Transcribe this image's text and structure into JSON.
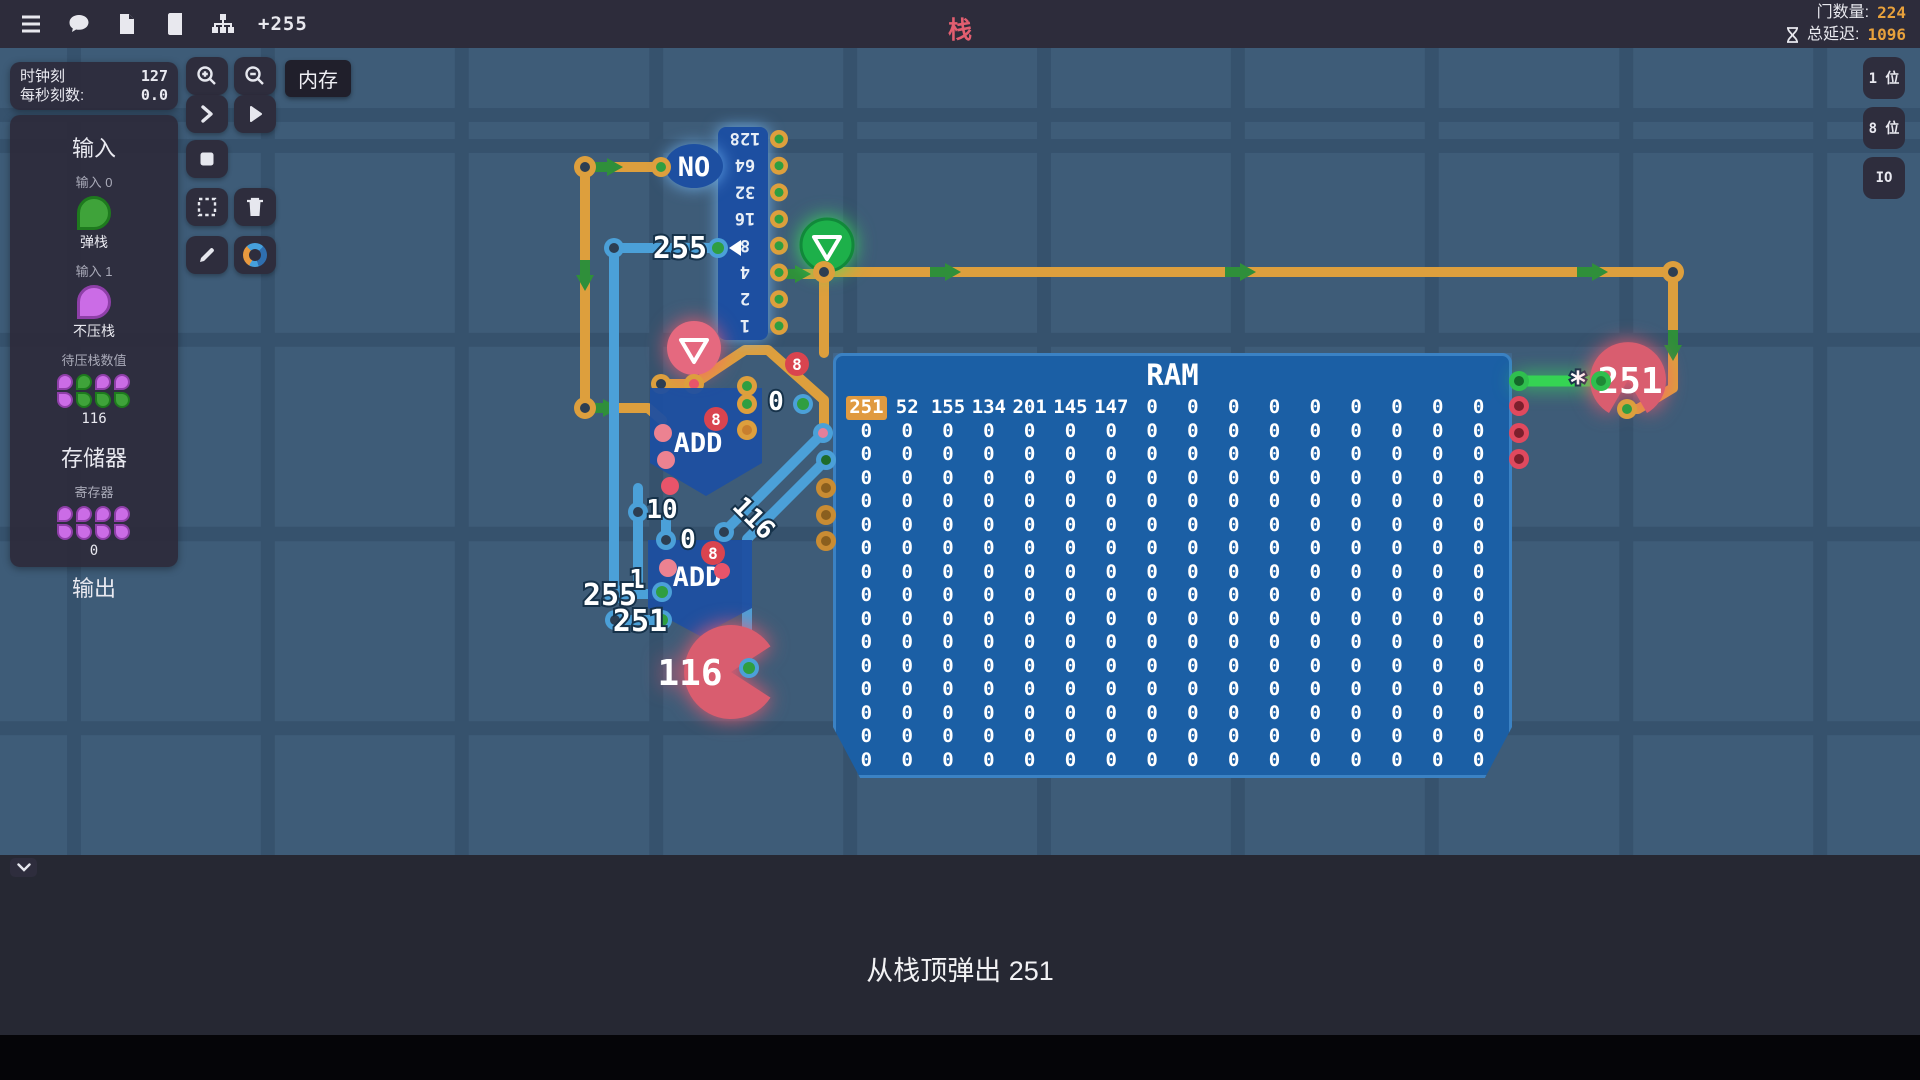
{
  "top_bar": {
    "plus_label": "+255",
    "title": "栈",
    "gate_count_label": "门数量:",
    "gate_count_value": "224",
    "delay_label": "总延迟:",
    "delay_value": "1096"
  },
  "clock_panel": {
    "tick_label": "时钟刻",
    "tick_value": "127",
    "rate_label": "每秒刻数:",
    "rate_value": "0.0"
  },
  "io_panel": {
    "input_header": "输入",
    "input0_label": "输入 0",
    "input0_name": "弹栈",
    "input0_bit": 1,
    "input1_label": "输入 1",
    "input1_name": "不压栈",
    "input1_bit": 0,
    "push_value_label": "待压栈数值",
    "push_value_bits": [
      [
        0,
        1,
        0,
        0
      ],
      [
        0,
        1,
        1,
        1
      ]
    ],
    "push_value": "116",
    "memory_header": "存储器",
    "register_label": "寄存器",
    "register_bits": [
      [
        0,
        0,
        0,
        0
      ],
      [
        0,
        0,
        0,
        0
      ]
    ],
    "register_value": "0",
    "output_header": "输出"
  },
  "memory_tag": "内存",
  "bit_width_buttons": [
    {
      "label": "1 位"
    },
    {
      "label": "8 位"
    },
    {
      "label": "IO"
    }
  ],
  "circuit": {
    "no_gate_label": "NO",
    "byte_input_label": "255",
    "splitter_bits": [
      "128",
      "64",
      "32",
      "16",
      "8",
      "4",
      "2",
      "1"
    ],
    "add_label": "ADD",
    "badge_label": "8",
    "labels": {
      "out0": "0",
      "sp10": "10",
      "sp0": "0",
      "sp1": "1",
      "sp255": "255",
      "sp251": "251",
      "diag116": "116",
      "asterisk": "*"
    },
    "output_value": "251",
    "address_value": "116",
    "ram": {
      "title": "RAM",
      "rows": [
        [
          "251",
          "52",
          "155",
          "134",
          "201",
          "145",
          "147",
          "0",
          "0",
          "0",
          "0",
          "0",
          "0",
          "0",
          "0",
          "0"
        ],
        [
          "0",
          "0",
          "0",
          "0",
          "0",
          "0",
          "0",
          "0",
          "0",
          "0",
          "0",
          "0",
          "0",
          "0",
          "0",
          "0"
        ],
        [
          "0",
          "0",
          "0",
          "0",
          "0",
          "0",
          "0",
          "0",
          "0",
          "0",
          "0",
          "0",
          "0",
          "0",
          "0",
          "0"
        ],
        [
          "0",
          "0",
          "0",
          "0",
          "0",
          "0",
          "0",
          "0",
          "0",
          "0",
          "0",
          "0",
          "0",
          "0",
          "0",
          "0"
        ],
        [
          "0",
          "0",
          "0",
          "0",
          "0",
          "0",
          "0",
          "0",
          "0",
          "0",
          "0",
          "0",
          "0",
          "0",
          "0",
          "0"
        ],
        [
          "0",
          "0",
          "0",
          "0",
          "0",
          "0",
          "0",
          "0",
          "0",
          "0",
          "0",
          "0",
          "0",
          "0",
          "0",
          "0"
        ],
        [
          "0",
          "0",
          "0",
          "0",
          "0",
          "0",
          "0",
          "0",
          "0",
          "0",
          "0",
          "0",
          "0",
          "0",
          "0",
          "0"
        ],
        [
          "0",
          "0",
          "0",
          "0",
          "0",
          "0",
          "0",
          "0",
          "0",
          "0",
          "0",
          "0",
          "0",
          "0",
          "0",
          "0"
        ],
        [
          "0",
          "0",
          "0",
          "0",
          "0",
          "0",
          "0",
          "0",
          "0",
          "0",
          "0",
          "0",
          "0",
          "0",
          "0",
          "0"
        ],
        [
          "0",
          "0",
          "0",
          "0",
          "0",
          "0",
          "0",
          "0",
          "0",
          "0",
          "0",
          "0",
          "0",
          "0",
          "0",
          "0"
        ],
        [
          "0",
          "0",
          "0",
          "0",
          "0",
          "0",
          "0",
          "0",
          "0",
          "0",
          "0",
          "0",
          "0",
          "0",
          "0",
          "0"
        ],
        [
          "0",
          "0",
          "0",
          "0",
          "0",
          "0",
          "0",
          "0",
          "0",
          "0",
          "0",
          "0",
          "0",
          "0",
          "0",
          "0"
        ],
        [
          "0",
          "0",
          "0",
          "0",
          "0",
          "0",
          "0",
          "0",
          "0",
          "0",
          "0",
          "0",
          "0",
          "0",
          "0",
          "0"
        ],
        [
          "0",
          "0",
          "0",
          "0",
          "0",
          "0",
          "0",
          "0",
          "0",
          "0",
          "0",
          "0",
          "0",
          "0",
          "0",
          "0"
        ],
        [
          "0",
          "0",
          "0",
          "0",
          "0",
          "0",
          "0",
          "0",
          "0",
          "0",
          "0",
          "0",
          "0",
          "0",
          "0",
          "0"
        ],
        [
          "0",
          "0",
          "0",
          "0",
          "0",
          "0",
          "0",
          "0",
          "0",
          "0",
          "0",
          "0",
          "0",
          "0",
          "0",
          "0"
        ]
      ]
    }
  },
  "status_message": "从栈顶弹出 251"
}
